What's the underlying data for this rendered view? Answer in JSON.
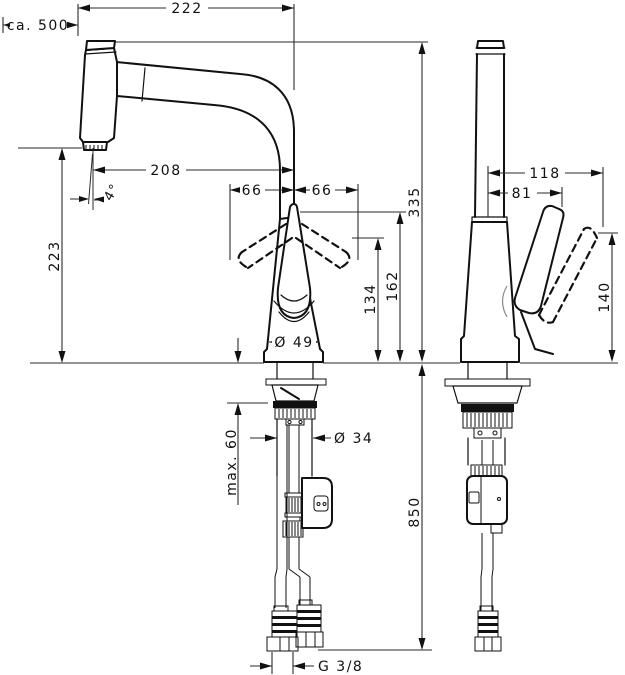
{
  "drawing": {
    "kind": "technical dimension drawing, kitchen mixer tap, front and side view"
  },
  "colors": {
    "background": "#ffffff",
    "outline": "#111111",
    "dimension_lines": "#2a2a2a"
  },
  "dimensions": {
    "wall_distance": "ca. 500",
    "spout_reach_total": "222",
    "spout_reach_aerator": "208",
    "lever_swing_left": "66",
    "lever_swing_right": "66",
    "spray_angle": "4°",
    "aerator_height": "223",
    "total_height": "335",
    "lever_height_up": "162",
    "lever_height_tilted": "134",
    "body_diameter": "Ø 49",
    "shank_diameter": "Ø 34",
    "max_counter_thickness": "max. 60",
    "hose_length": "850",
    "thread_size": "G 3/8",
    "lever_reach_tilted": "118",
    "lever_reach_up": "81",
    "lever_clearance_height": "140"
  }
}
